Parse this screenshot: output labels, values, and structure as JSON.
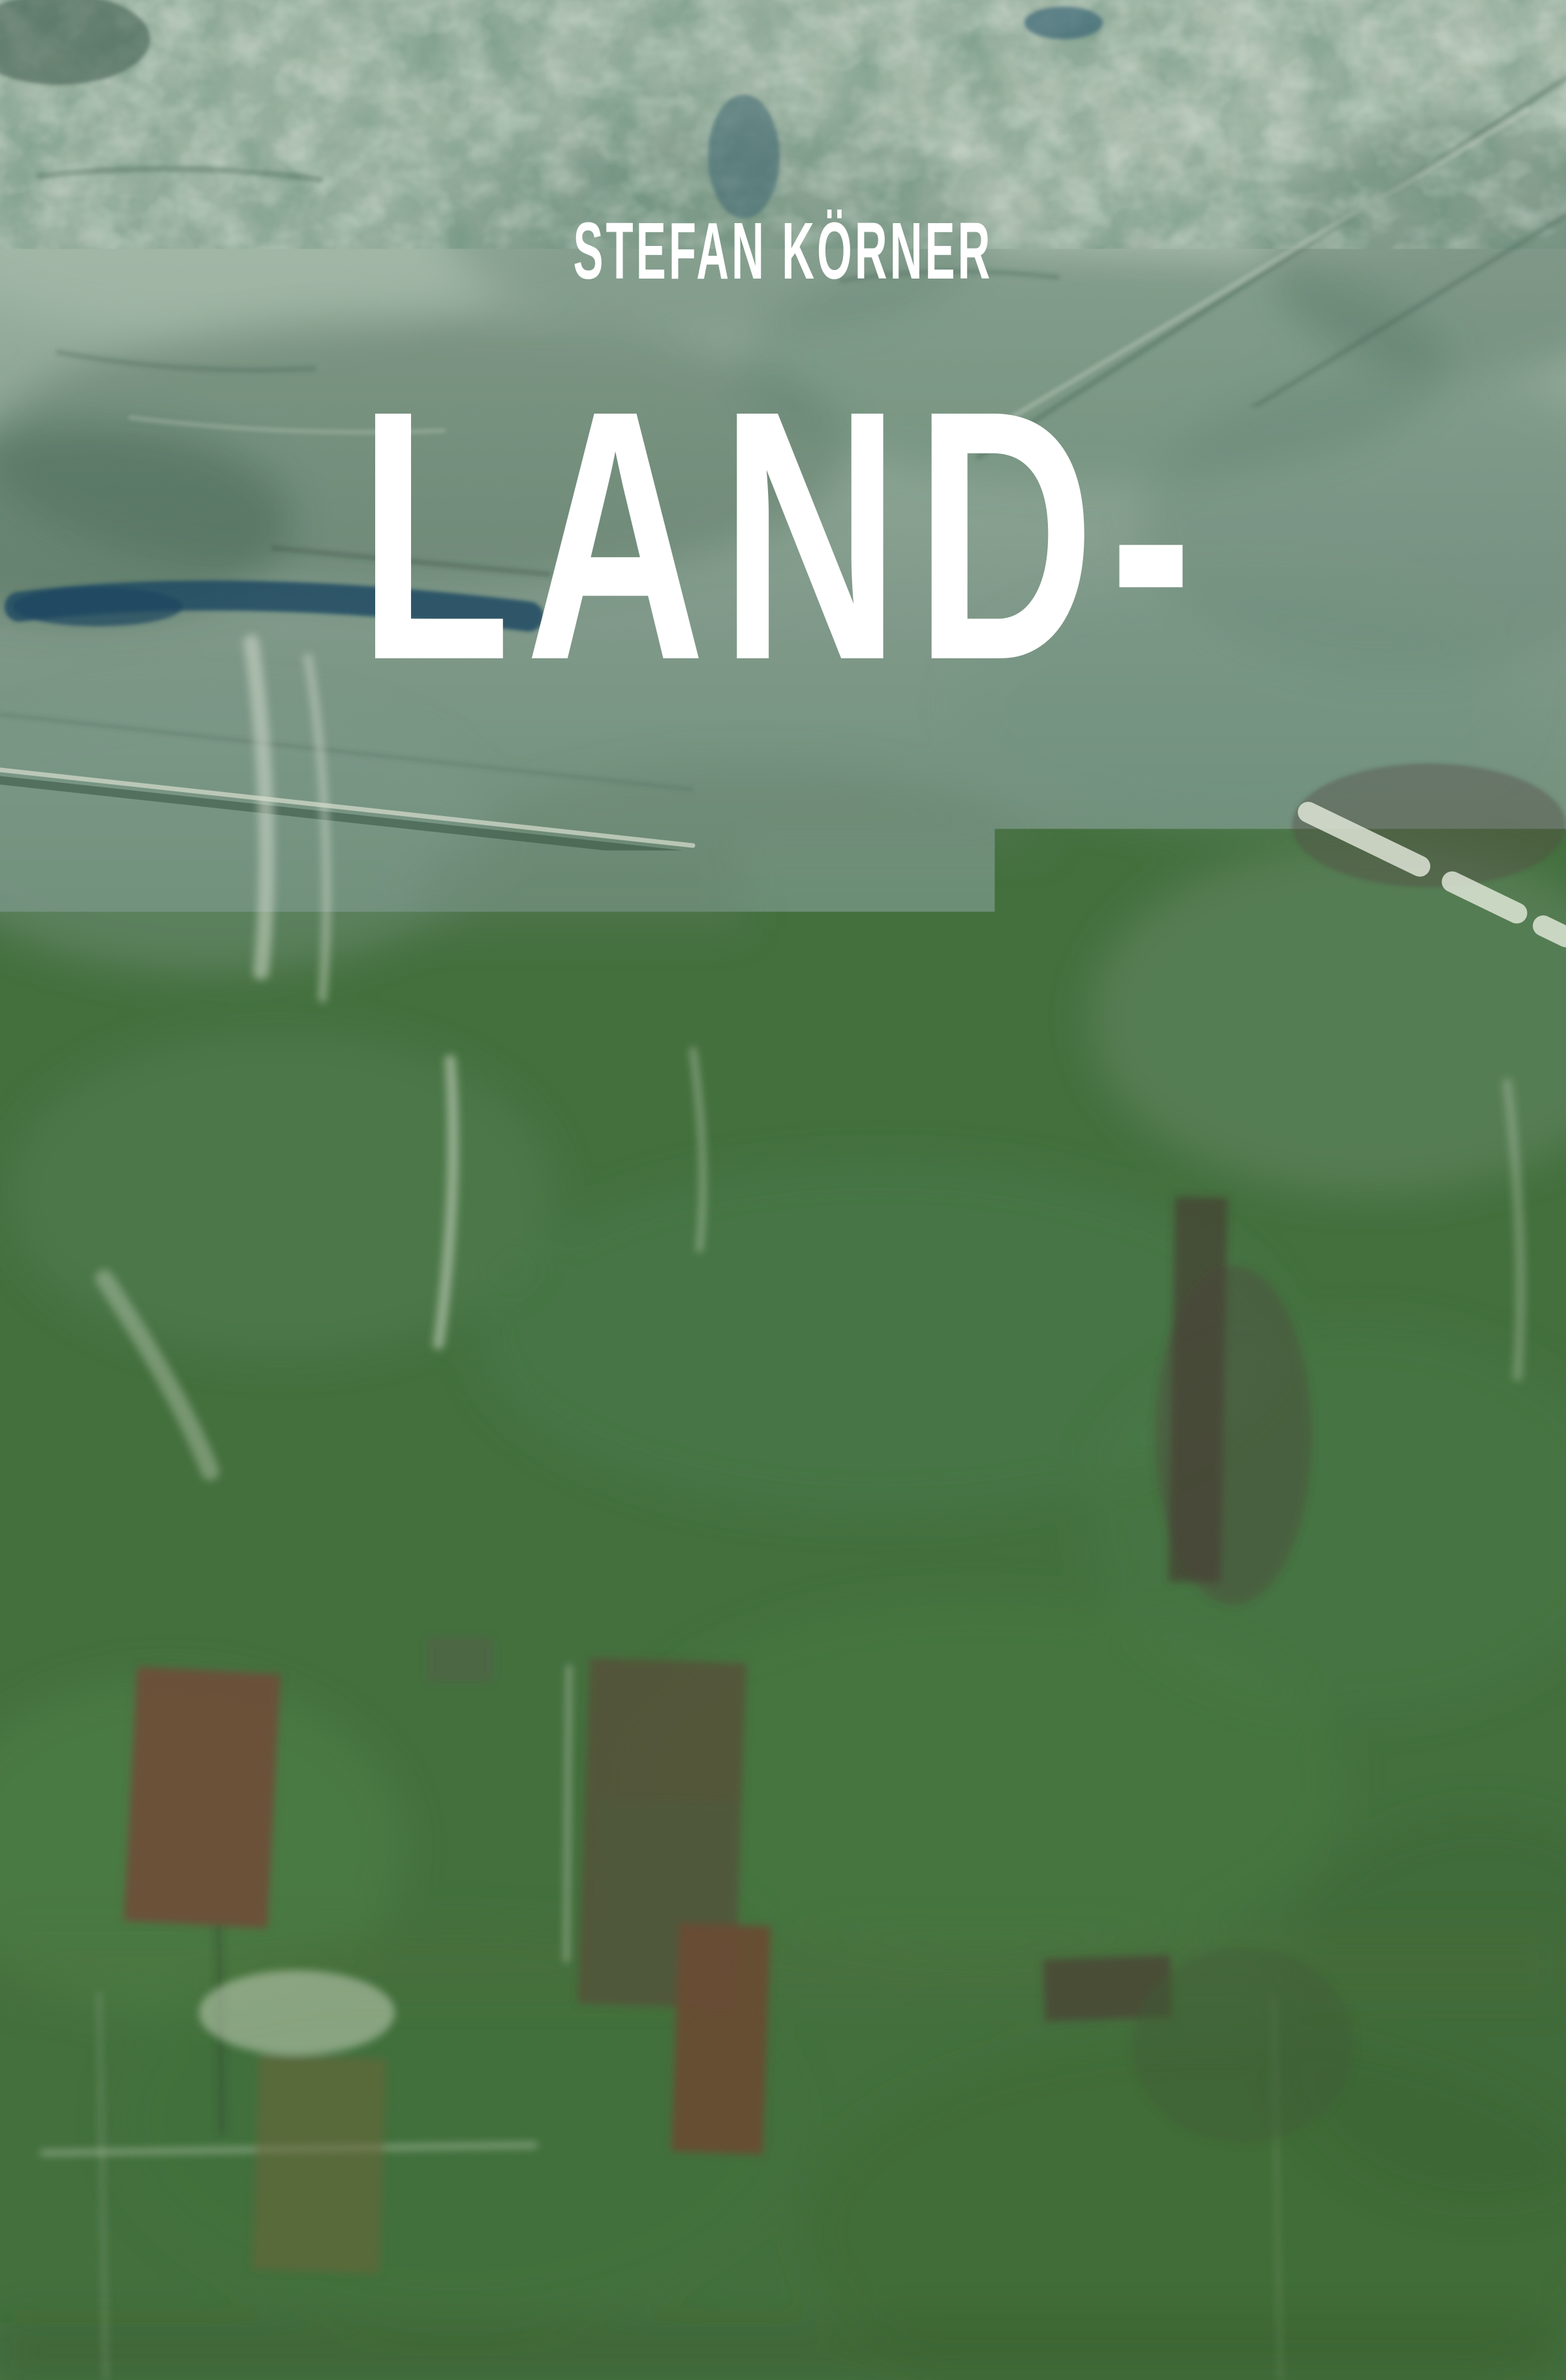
{
  "cover": {
    "author": "STEFAN KÖRNER",
    "title_lines": [
      "LAND-",
      "SCHAFT",
      "ALS",
      "PROJEKT"
    ],
    "subtitle": "PLANUNG, PFLEGE, SINNSTIFTUNG",
    "publisher": {
      "bracket_left": "[",
      "name": "transcript",
      "bracket_right": "]",
      "series": "Neue Ökologie"
    },
    "palette": {
      "text": "#ffffff",
      "top_sage": "#a7baab",
      "mid_green": "#588459",
      "bottom_green": "#395c2f",
      "road_tan": "#b2ae95",
      "field_brown": "#6f4e37",
      "paint_blue": "#1e4a63"
    }
  }
}
